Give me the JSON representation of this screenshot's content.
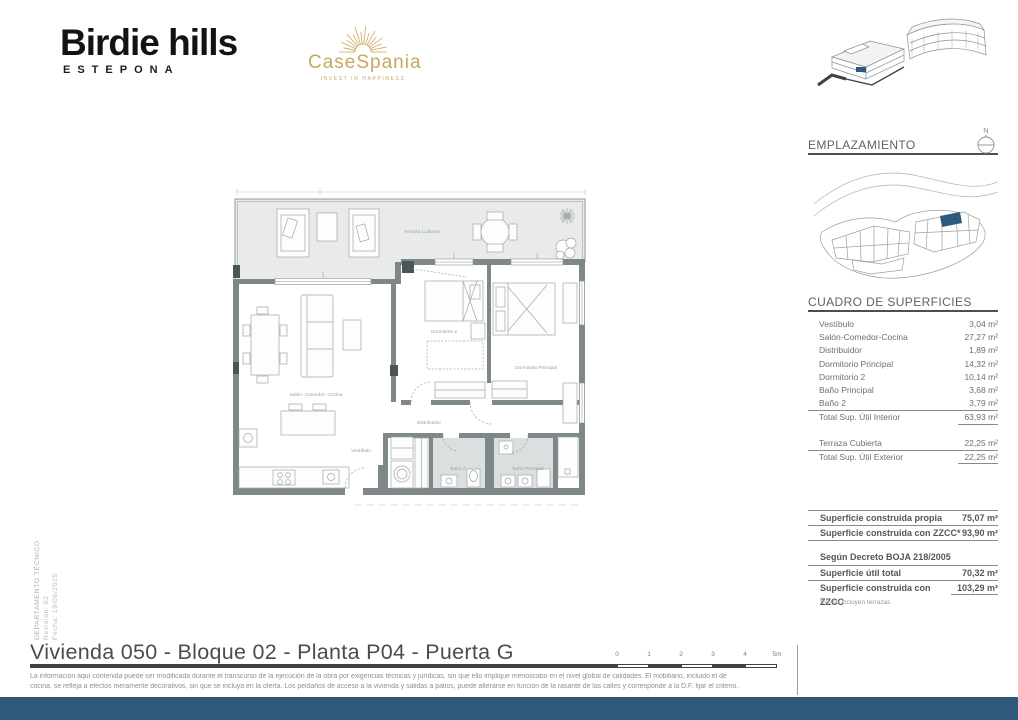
{
  "branding": {
    "logo_title": "Birdie hills",
    "logo_subtitle": "ESTEPONA",
    "partner_logo": "CaseSpania",
    "partner_tagline": "INVEST IN HAPPINESS",
    "gold_color": "#c9a75f"
  },
  "sidebar": {
    "emplazamiento_title": "EMPLAZAMIENTO",
    "compass_label": "N",
    "highlight_color": "#2e597b",
    "surfaces": {
      "title": "CUADRO DE SUPERFICIES",
      "rows": [
        {
          "label": "Vestíbulo",
          "value": "3,04 m²"
        },
        {
          "label": "Salón-Comedor-Cocina",
          "value": "27,27 m²"
        },
        {
          "label": "Distribuidor",
          "value": "1,89 m²"
        },
        {
          "label": "Dormitorio Principal",
          "value": "14,32 m²"
        },
        {
          "label": "Dormitorio 2",
          "value": "10,14 m²"
        },
        {
          "label": "Baño Principal",
          "value": "3,68 m²"
        },
        {
          "label": "Baño 2",
          "value": "3,79 m²"
        }
      ],
      "total_interior": {
        "label": "Total Sup. Útil Interior",
        "value": "63,93 m²"
      },
      "terraza": {
        "label": "Terraza Cubierta",
        "value": "22,25 m²"
      },
      "total_exterior": {
        "label": "Total Sup. Útil Exterior",
        "value": "22,25 m²"
      }
    },
    "construida": {
      "rows": [
        {
          "label": "Superficie construida propia",
          "value": "75,07 m²"
        },
        {
          "label": "Superficie construida con ZZCC*",
          "value": "93,90 m²"
        }
      ],
      "decree_header": "Según Decreto BOJA 218/2005",
      "decree_rows": [
        {
          "label": "Superficie útil total",
          "value": "70,32 m²"
        },
        {
          "label": "Superficie construida con ZZCC",
          "value": "103,29 m²"
        }
      ],
      "footnote": "*No se incluyen terrazas"
    }
  },
  "plan": {
    "room_labels": [
      "Terraza Cubierta",
      "Salón- Comedor- Cocina",
      "Dormitorio 2",
      "Dormitorio Principal",
      "Distribuidor",
      "Vestíbulo",
      "Baño 2",
      "Baño Principal"
    ],
    "wall_color": "#7e8888",
    "terrace_fill": "#e9ebeb",
    "bath_fill": "#dcdfdf"
  },
  "footer": {
    "title": "Vivienda 050 - Bloque 02 - Planta P04 - Puerta G",
    "scale_labels": [
      "0",
      "1",
      "2",
      "3",
      "4",
      "5m"
    ],
    "disclaimer_line1": "La información aquí contenida puede  ser modificada durante el transcurso de la ejecución de la obra por exigencias técnicas y jurídicas,  sin  que  ello  implique  menoscabo  en el nivel global de calidades.  El  mobiliario, incluido el de",
    "disclaimer_line2": "cocina, se refleja a efectos meramente decorativos, sin que se incluya en la oferta. Los peldaños de acceso a la vivienda y  salidas  a patios,  puede alterarse  en función de la rasante de las calles y corresponde a  la  D.F.  fijar el criterio.",
    "bar_color": "#2e597b"
  },
  "side_meta": {
    "department": "DEPARTAMENTO TÉCNICO",
    "revision": "Revisión: 02",
    "date": "Fecha: 19/06/2025"
  }
}
